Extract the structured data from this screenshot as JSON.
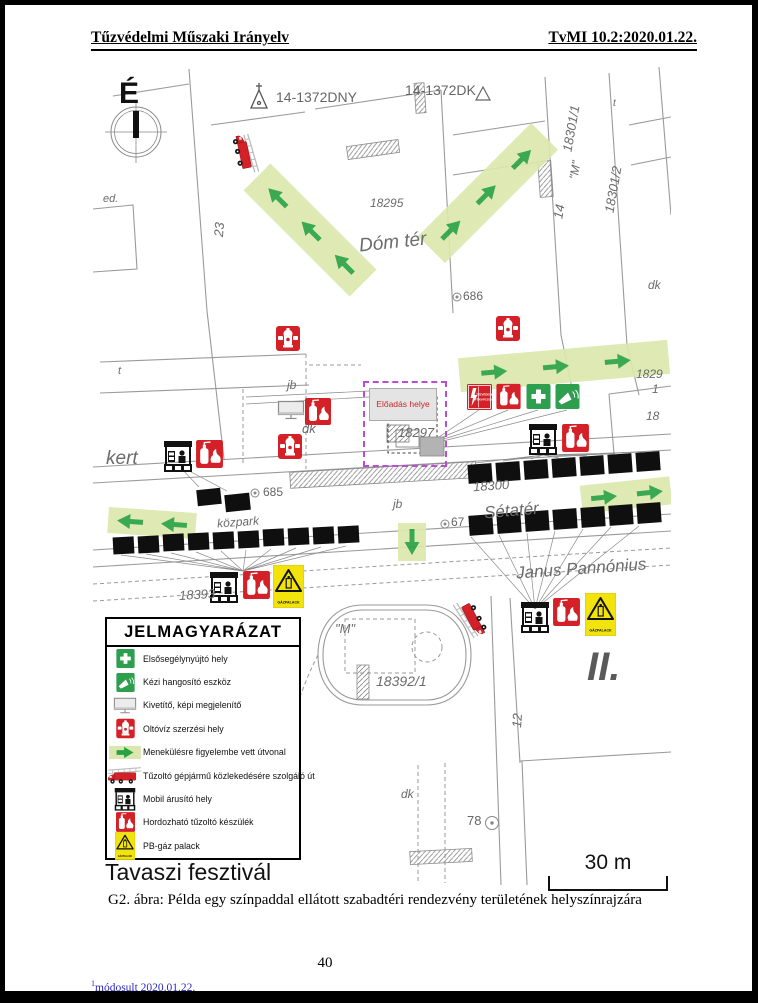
{
  "page": {
    "header_left": "Tűzvédelmi Műszaki Irányelv",
    "header_right": "TvMI 10.2:2020.01.22.",
    "caption": "G2. ábra: Példa egy színpaddal ellátott szabadtéri rendezvény területének helyszínrajzára",
    "page_number": "40",
    "footnote_sup": "1",
    "footnote_text": "módosult 2020.01.22."
  },
  "map": {
    "compass": "É",
    "title": "Tavaszi fesztivál",
    "scale_label": "30 m",
    "stage_label": "Előadás helye",
    "signs": {
      "fokapcsolo_line1": "TŰZVÉDELMI",
      "fokapcsolo_line2": "FŐKAPCSOLÓ",
      "gazpalack": "GÁZPALACK"
    },
    "labels": {
      "dny": "14-1372DNY",
      "dkp": "14-1372DK",
      "p18295": "18295",
      "dom_ter": "Dóm tér",
      "p18301_1": "18301/1",
      "p18301_2": "18301/2",
      "m_quoted": "\"M\"",
      "n14": "14",
      "n23": "23",
      "n12": "12",
      "ed": "ed.",
      "t": "t",
      "jb": "jb",
      "dk": "dk",
      "n686": "686",
      "n685": "685",
      "n67": "67",
      "n78": "78",
      "kert": "kert",
      "kozpark": "közpark",
      "p18297": "18297",
      "p18300": "18300",
      "setater": "Sétatér",
      "janus": "Janus Pannónius",
      "p1839x": "18393",
      "p18392_1": "18392/1",
      "district": "II.",
      "p1829x": "1829",
      "p1": "1",
      "p18": "18"
    }
  },
  "legend": {
    "title": "JELMAGYARÁZAT",
    "items": [
      {
        "icon": "first-aid-sign",
        "label": "Elsősegélynyújtó hely"
      },
      {
        "icon": "megaphone-sign",
        "label": "Kézi hangosító eszköz"
      },
      {
        "icon": "projector-screen",
        "label": "Kivetítő, képi megjelenítő"
      },
      {
        "icon": "hydrant-sign",
        "label": "Oltóvíz szerzési hely"
      },
      {
        "icon": "escape-route-arrow",
        "label": "Menekülésre figyelembe vett útvonal"
      },
      {
        "icon": "fire-truck",
        "label": "Tűzoltó gépjármű közlekedésére szolgáló út"
      },
      {
        "icon": "vendor-stand",
        "label": "Mobil árusító hely"
      },
      {
        "icon": "fire-extinguisher-sign",
        "label": "Hordozható tűzoltó készülék"
      },
      {
        "icon": "gas-cylinder-warning",
        "label": "PB-gáz palack"
      }
    ]
  },
  "colors": {
    "sign_red": "#d42127",
    "sign_green": "#2e9e4f",
    "route_fill": "#dbe7ae",
    "route_arrow": "#2aa244",
    "warning_yellow": "#f2e30c",
    "stage_outline": "#b84fd0",
    "footnote_blue": "#2a2ac4"
  }
}
